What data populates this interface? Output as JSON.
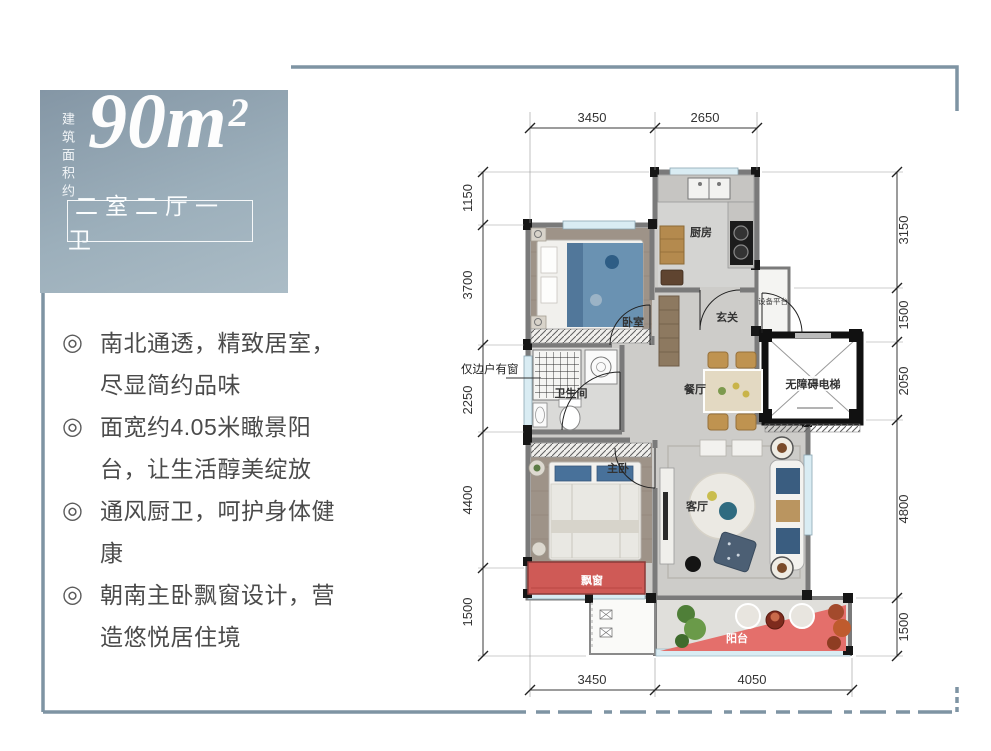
{
  "area_card": {
    "vertical_label": "建筑面积约",
    "area_number": "90m",
    "area_sup": "2",
    "layout_tag": "二室二厅一卫"
  },
  "features": {
    "bullet": "◎",
    "items": [
      "南北通透，精致居室，尽显简约品味",
      "面宽约4.05米瞰景阳台，让生活醇美绽放",
      "通风厨卫，呵护身体健康",
      "朝南主卧飘窗设计，营造悠悦居住境"
    ]
  },
  "floor_plan": {
    "rooms": {
      "kitchen": "厨房",
      "entry": "玄关",
      "equipment": "设备平台",
      "elevator": "无障碍电梯",
      "bedroom": "卧室",
      "bathroom": "卫生间",
      "dining": "餐厅",
      "master_bedroom": "主卧",
      "bay_window": "飘窗",
      "living": "客厅",
      "balcony": "阳台"
    },
    "window_note": "仅边户有窗",
    "dimensions": {
      "top": [
        "3450",
        "2650"
      ],
      "left": [
        "1150",
        "3700",
        "2250",
        "4400",
        "1500"
      ],
      "right": [
        "3150",
        "1500",
        "2050",
        "4800",
        "1500"
      ],
      "bottom": [
        "3450",
        "4050"
      ]
    }
  },
  "colors": {
    "frame": "#7e94a3",
    "card_top": "#8496a5",
    "card_bottom": "#abbcc6",
    "wall": "#7a7a7a",
    "wood_floor": "#a0958a",
    "accent_red": "#d95f5c",
    "furniture_blue": "#5d87ab",
    "window_blue": "#d9ecf3"
  }
}
